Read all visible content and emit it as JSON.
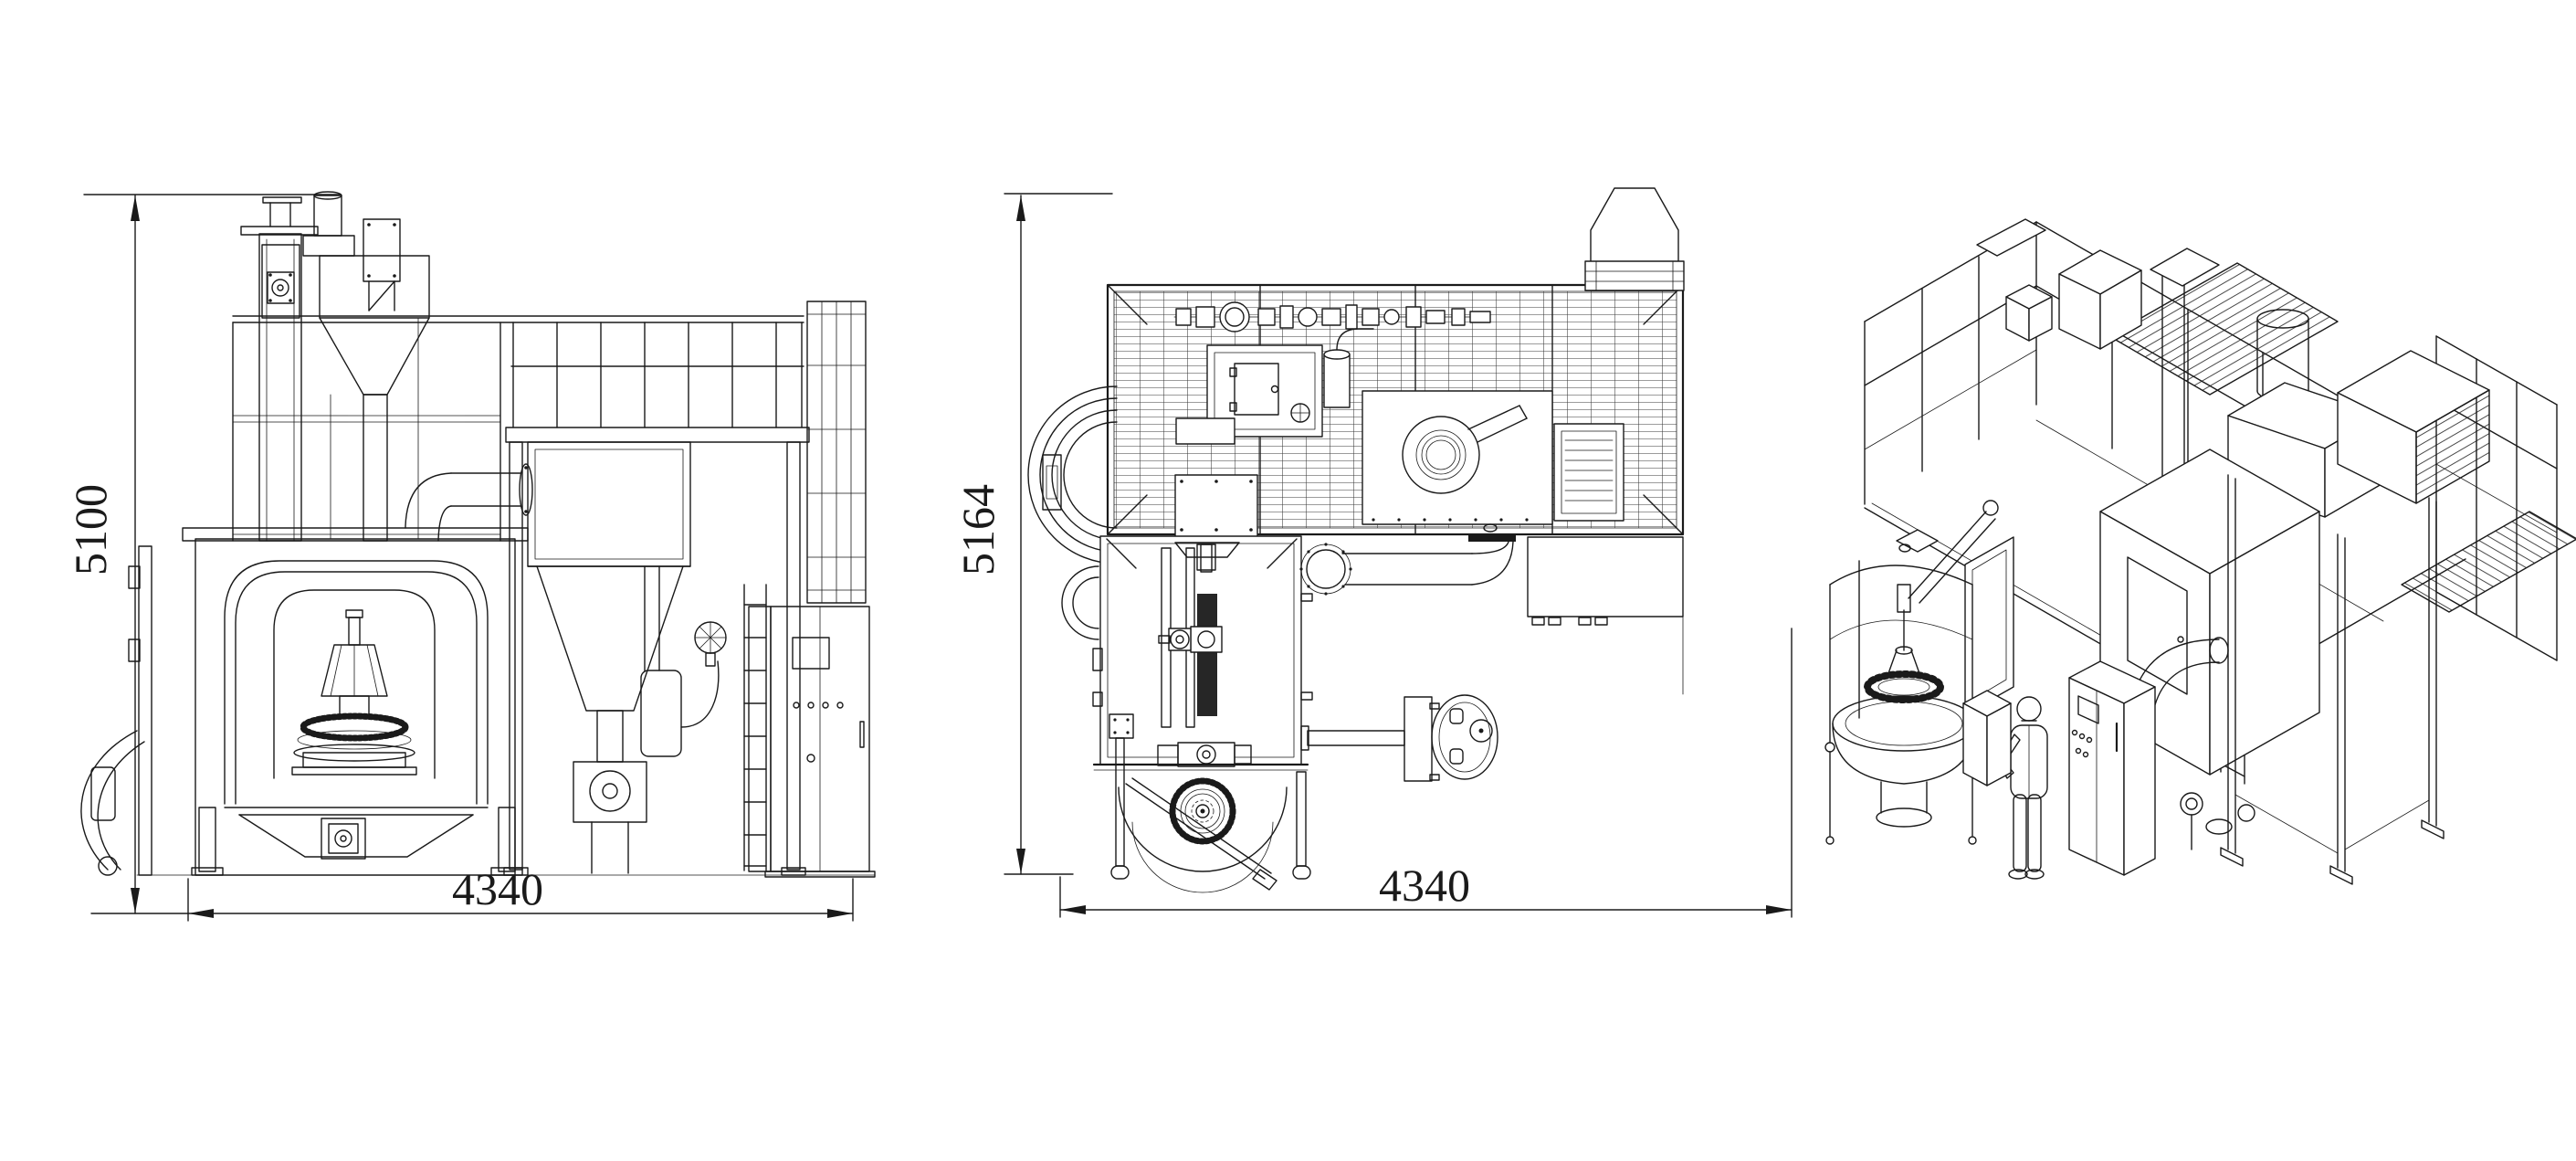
{
  "drawing": {
    "type": "engineering-three-view-cad",
    "subject": "shot-blast machine general arrangement drawing",
    "colors": {
      "background": "#ffffff",
      "line": "#1a1a1a",
      "dark_fill": "#262626"
    },
    "views": {
      "front": {
        "height_label": "5100",
        "width_label": "4340"
      },
      "plan": {
        "height_label": "5164",
        "width_label": "4340"
      },
      "isometric": {}
    }
  }
}
